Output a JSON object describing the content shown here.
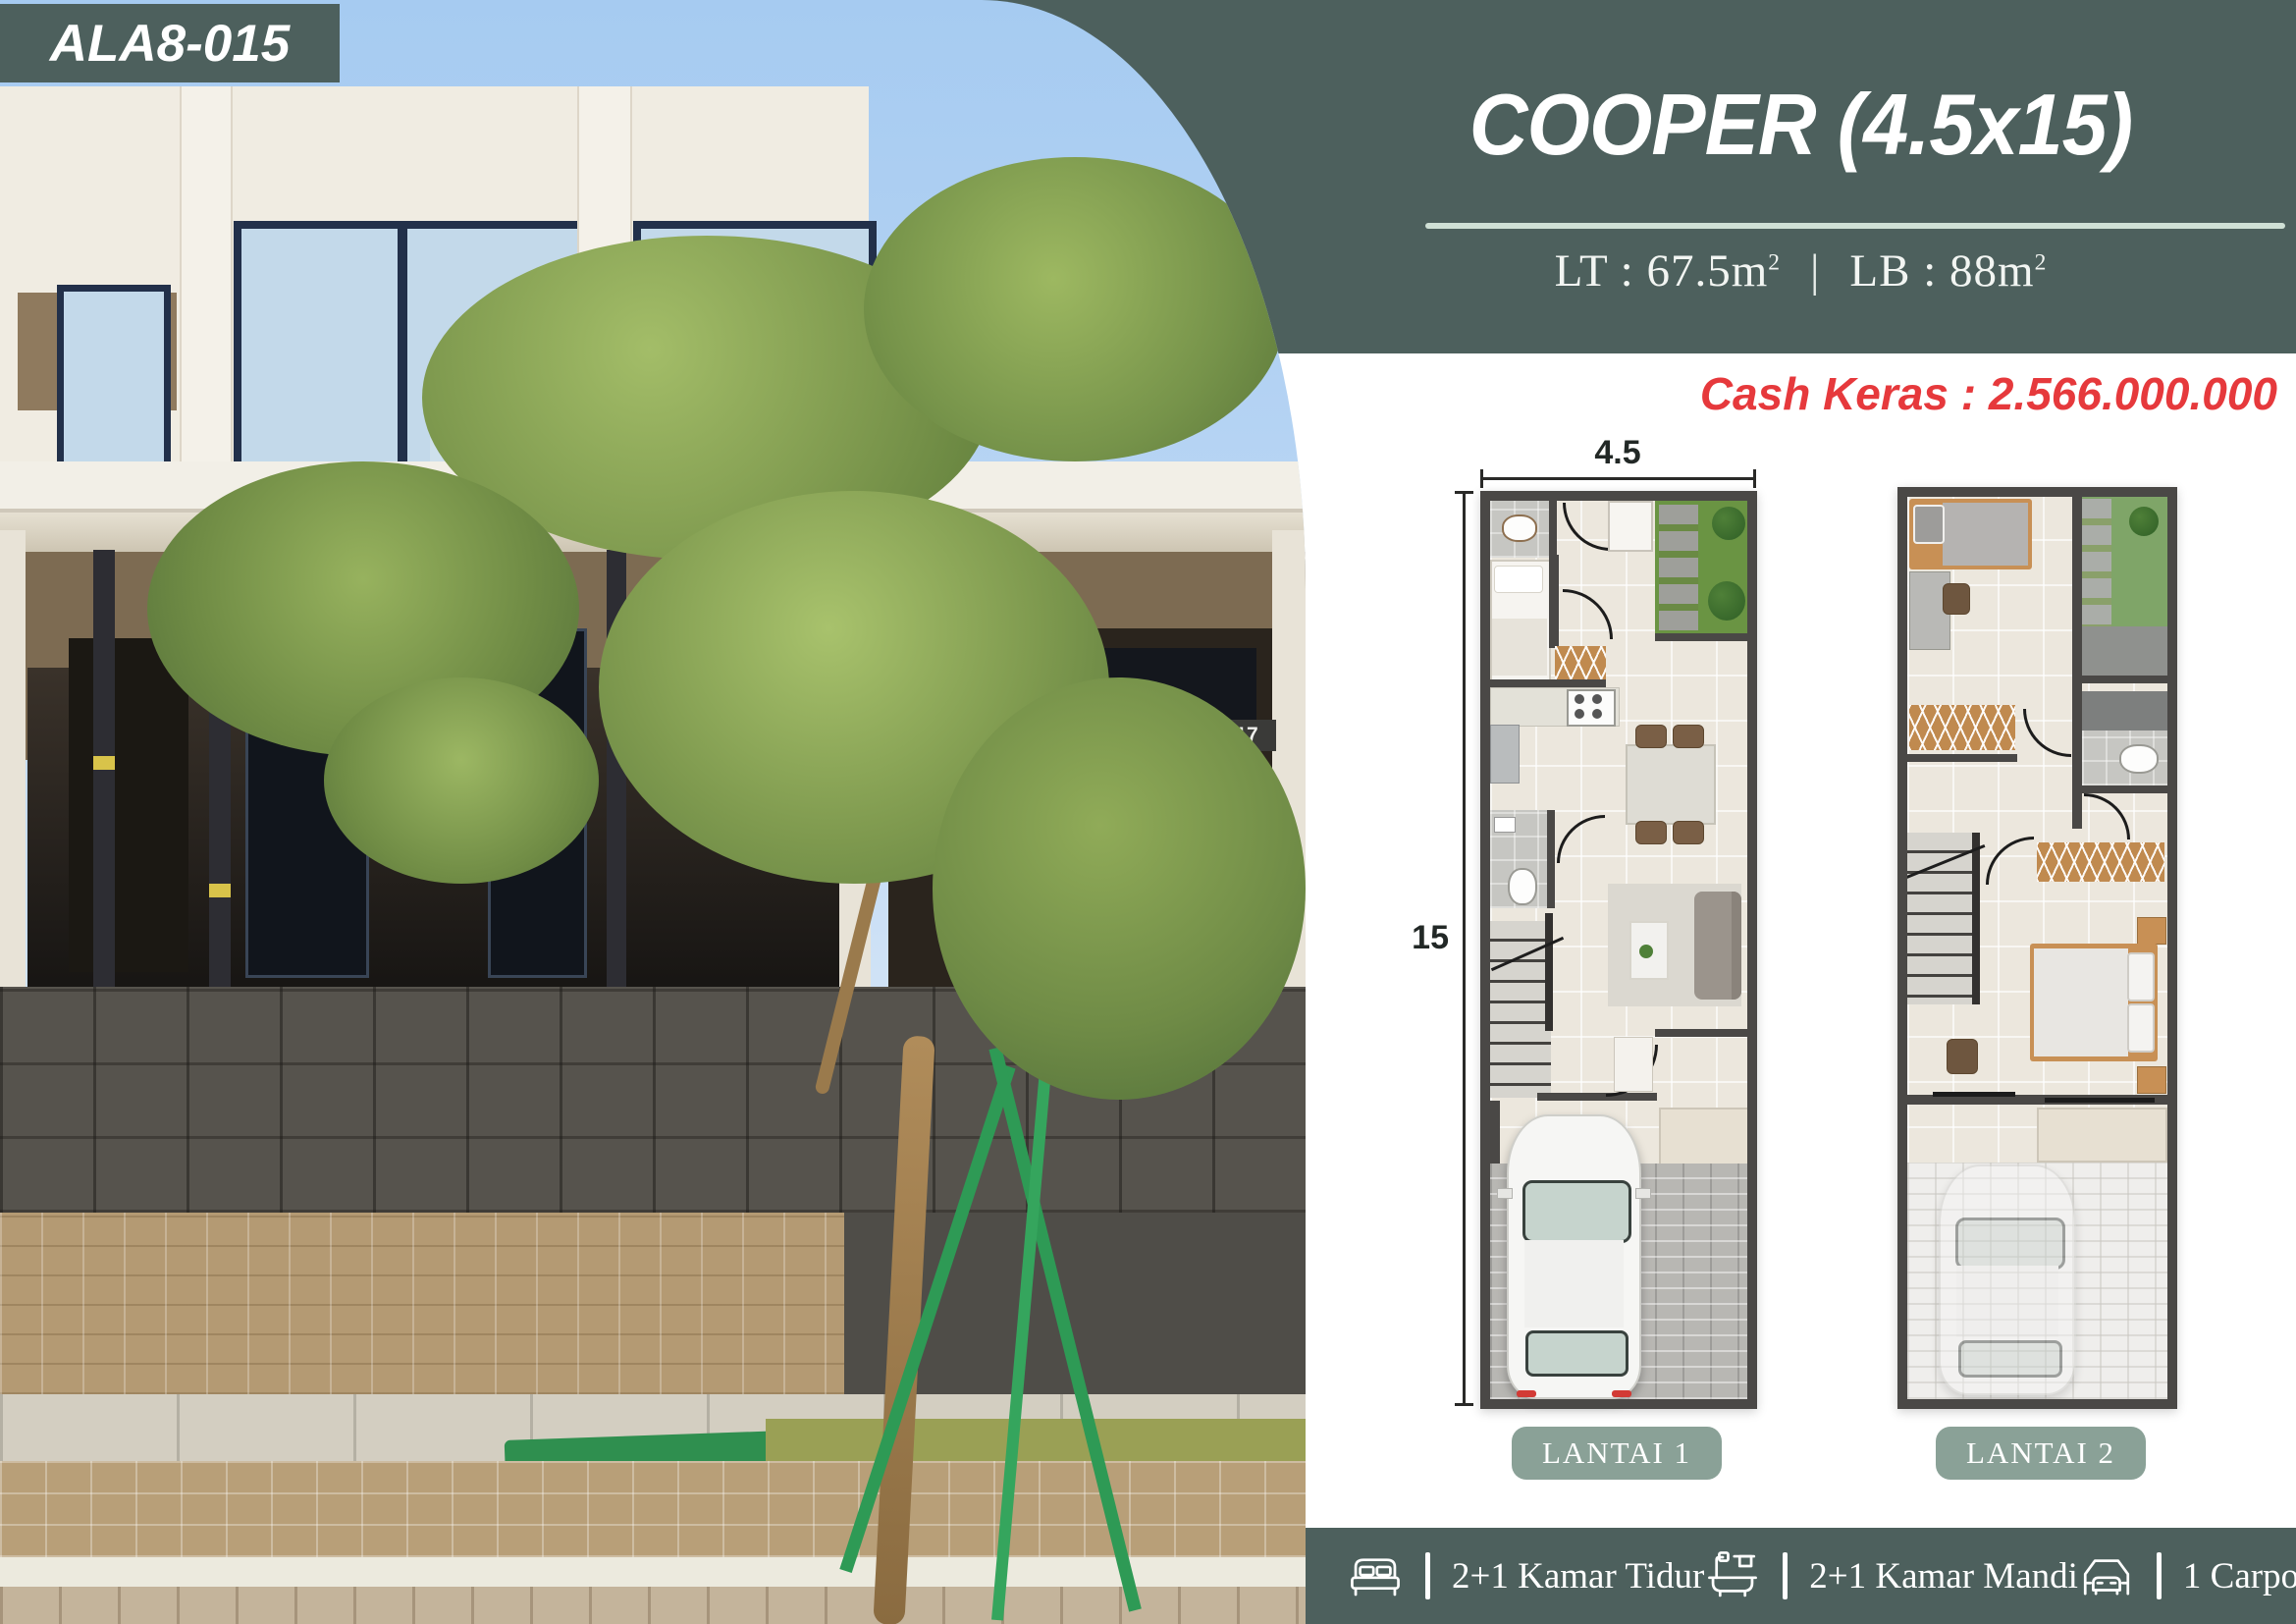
{
  "badge": {
    "code": "ALA8-015"
  },
  "header": {
    "title": "COOPER (4.5x15)",
    "land": "LT : 67.5m",
    "land_sup": "2",
    "building": "LB : 88m",
    "building_sup": "2",
    "separator": "|"
  },
  "price": {
    "text": "Cash Keras : 2.566.000.000"
  },
  "floorplans": {
    "width_dim": "4.5",
    "depth_dim": "15",
    "lantai1_label": "LANTAI 1",
    "lantai2_label": "LANTAI 2"
  },
  "photo": {
    "house_number_left": "15",
    "house_number_right": "17"
  },
  "amenities": [
    {
      "icon": "bed-icon",
      "label": "2+1 Kamar Tidur"
    },
    {
      "icon": "bathtub-icon",
      "label": "2+1 Kamar Mandi"
    },
    {
      "icon": "car-icon",
      "label": "1 Carport"
    }
  ],
  "colors": {
    "teal": "#4d605d",
    "mint_underline": "#cfe0d5",
    "price_red": "#e6393c",
    "button_green": "#8aa197"
  }
}
